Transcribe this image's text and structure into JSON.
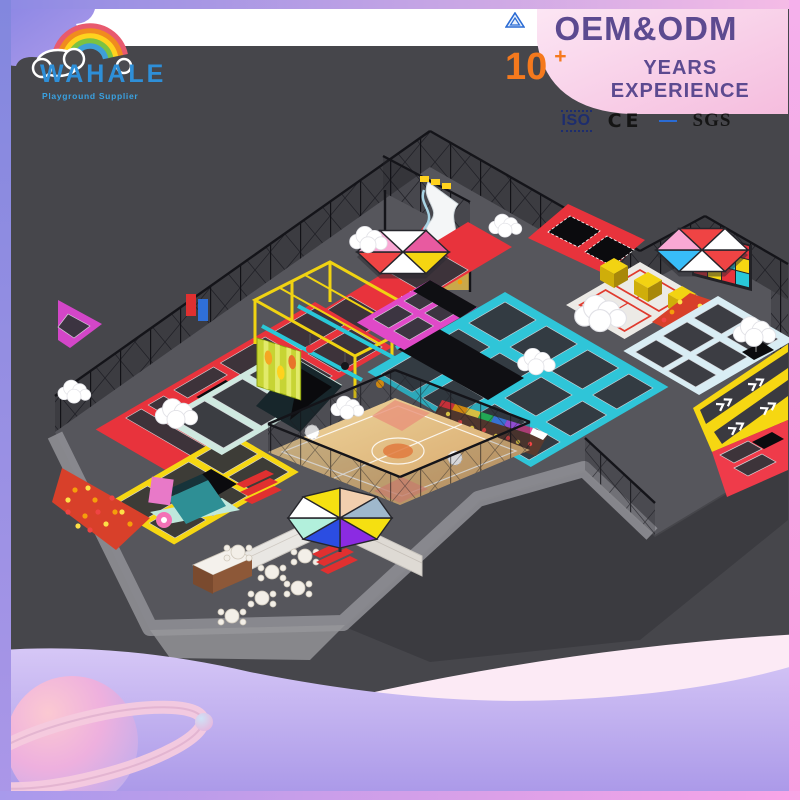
{
  "brand": {
    "name": "WAHALE",
    "tagline": "Playground Supplier"
  },
  "banner": {
    "title": "OEM&ODM",
    "years_value": "10",
    "years_plus": "+",
    "years_label": "YEARS EXPERIENCE"
  },
  "certifications": {
    "iso": "ISO",
    "ce": "CE",
    "sgs": "SGS"
  },
  "colors": {
    "background_dark": "#46464b",
    "frame_purple": "#8589e0",
    "frame_pink": "#fba4e6",
    "panel_pink": "#f8cde8",
    "title_purple": "#5c4a90",
    "accent_orange": "#f5791d",
    "logo_blue": "#2e8fd8",
    "zone_red": "#e8333c",
    "zone_yellow": "#f6d712",
    "zone_cyan": "#2fc5d8",
    "zone_magenta": "#d94fc4",
    "zone_paleblue": "#d9edf4",
    "court_wood": "#e2b87e",
    "wave_lavender": "#beaef0"
  }
}
